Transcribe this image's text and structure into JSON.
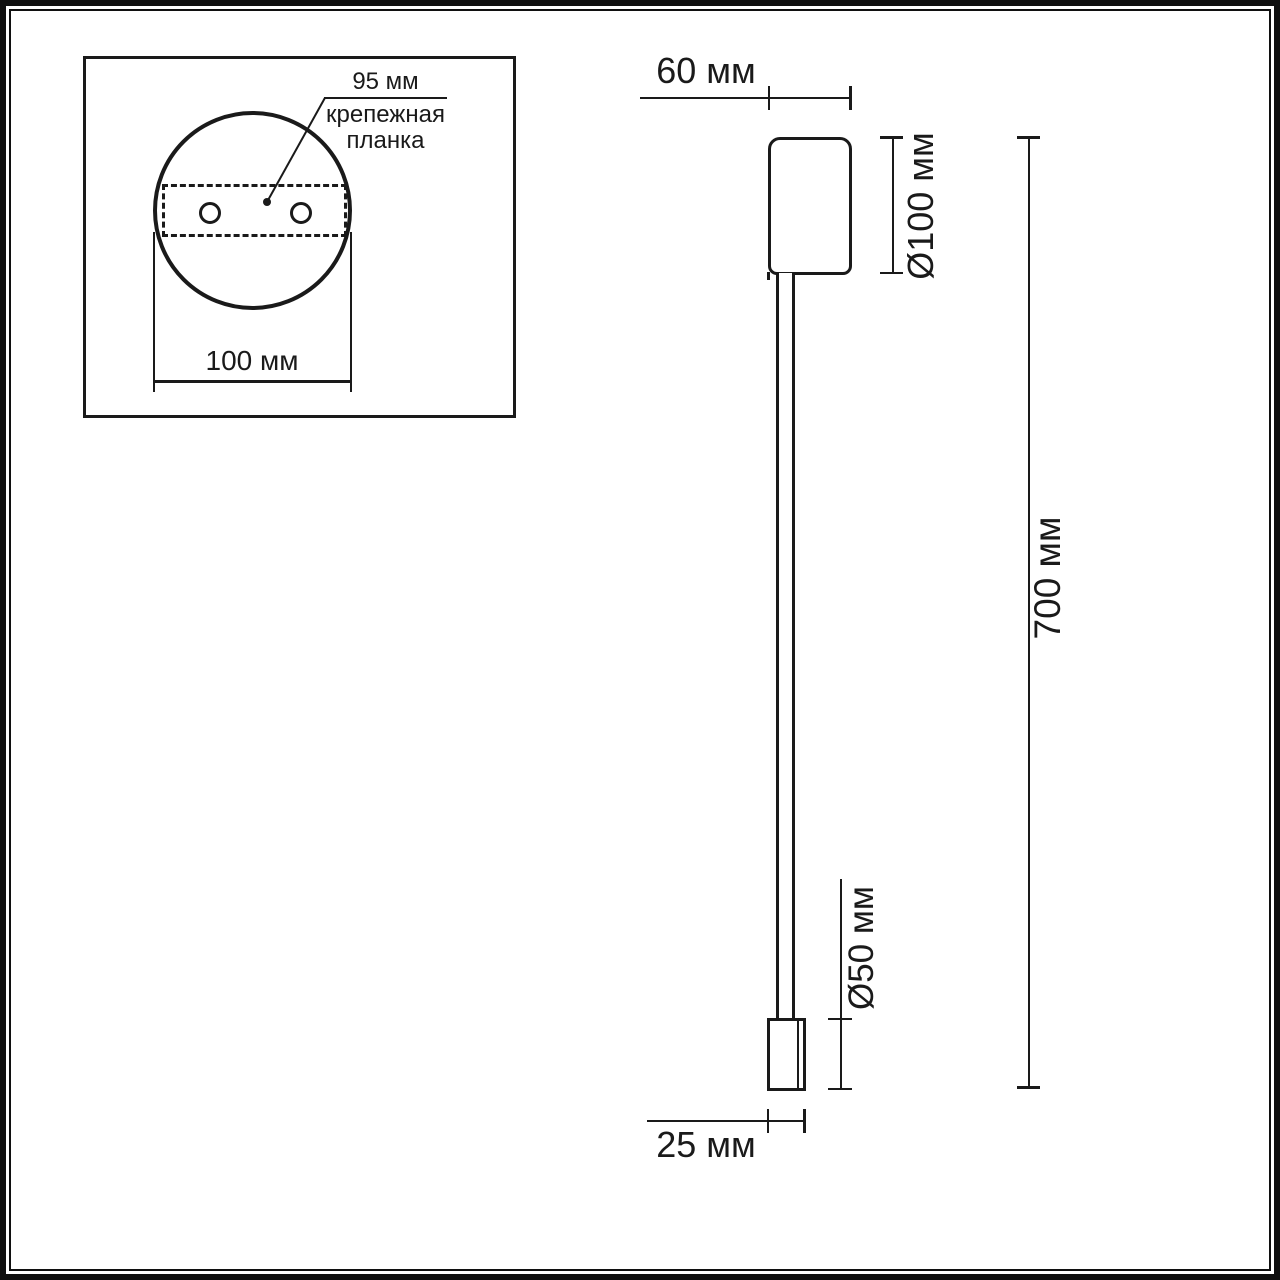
{
  "drawing": {
    "inset": {
      "plate_span_label": "95 мм",
      "plate_caption": [
        "крепежная",
        "планка"
      ],
      "plate_width_label": "100 мм"
    },
    "side_view": {
      "top_depth_label": "60 мм",
      "head_diameter_label": "Ø100 мм",
      "total_height_label": "700 мм",
      "tip_diameter_label": "Ø50 мм",
      "tip_width_label": "25 мм"
    }
  },
  "colors": {
    "ink": "#1a1a1a",
    "background": "#ffffff"
  }
}
